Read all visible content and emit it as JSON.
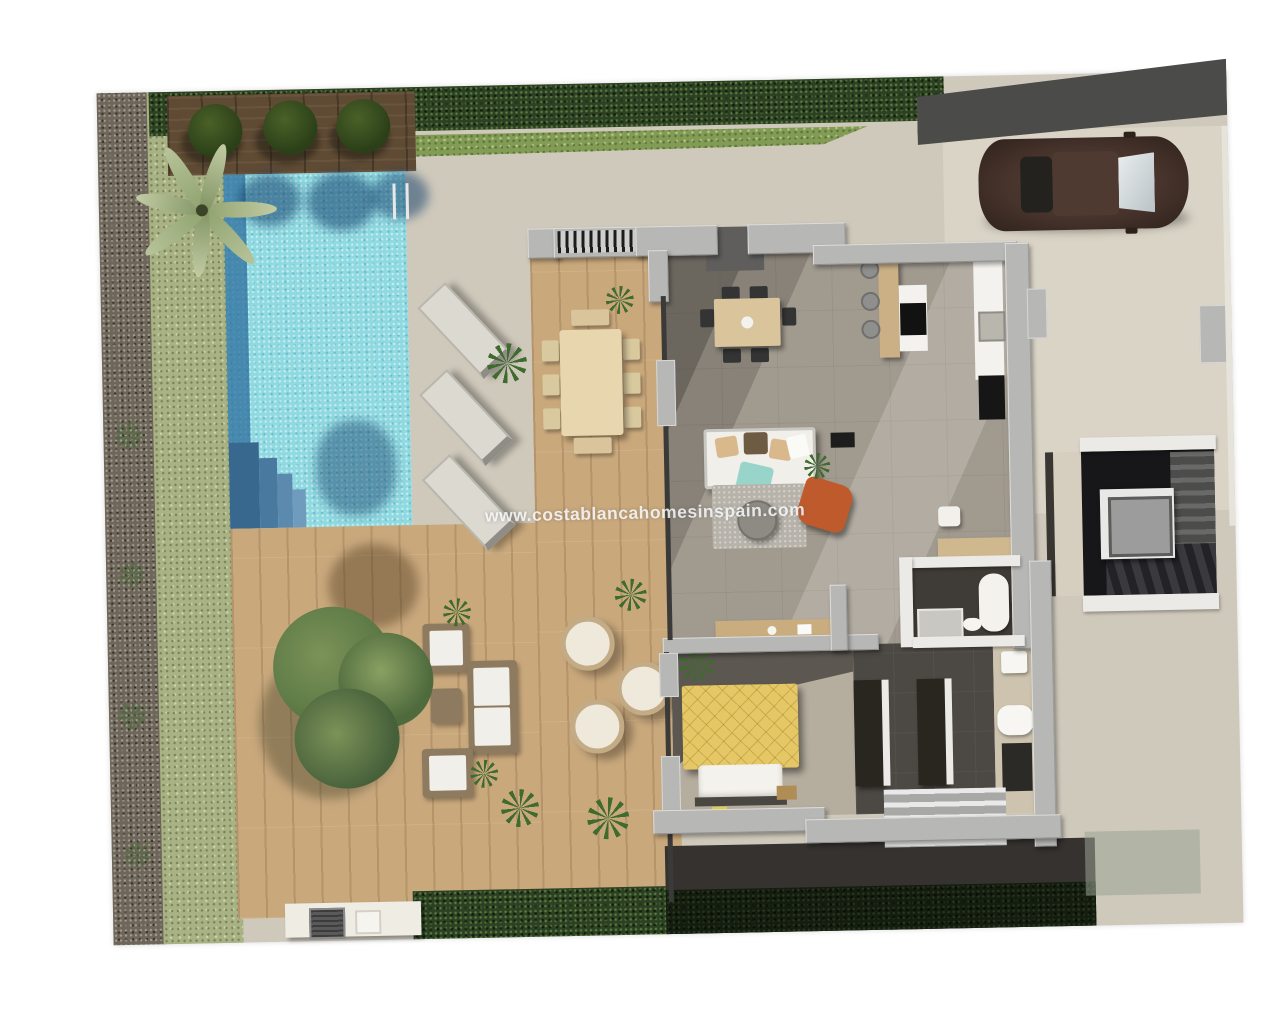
{
  "watermark": {
    "text": "www.costablancahomesinspain.com"
  },
  "scene": {
    "description_labels": {
      "pool": "swimming-pool",
      "garden": "lawn-garden",
      "terrace": "stone-terrace",
      "living_room": "open-plan-living-room",
      "kitchen": "kitchen-island",
      "bedroom": "bedroom",
      "bathroom": "bathroom",
      "stairwell": "stairwell-with-elevator",
      "driveway": "driveway-with-car",
      "bbq": "bbq-counter"
    }
  },
  "colors": {
    "page_bg": "#ffffff",
    "stone_terrace": "#cfc9bb",
    "driveway_stone": "#dad4c6",
    "road_asphalt": "#4b4b49",
    "gravel": "#6e6659",
    "grass": "#a9b284",
    "hedge_dark": "#2c4123",
    "hedge_light": "#829b55",
    "deck_dark_wood": "#5f4a33",
    "deck_light_wood": "#c9a87c",
    "pool_water": "#8fd9e0",
    "pool_shadow": "#2e6d9d",
    "wall_gray": "#b7b7b5",
    "wall_white": "#eceae6",
    "interior_floor": "#a19a8f",
    "interior_dark_floor": "#4c4843",
    "furniture_white": "#f1efe9",
    "furniture_wood": "#d9c49c",
    "bed_yellow": "#e5c766",
    "accent_orange": "#bf5a2d",
    "throw_teal": "#8fd0c6",
    "car_body": "#46332b",
    "stair_dark": "#17171a",
    "elevator_gray": "#9c9c9c",
    "tree_green": "#5d7a46",
    "plant_green": "#3f6b2f",
    "rattan": "#8d7a5f",
    "rug_gray": "#b7b3aa"
  }
}
